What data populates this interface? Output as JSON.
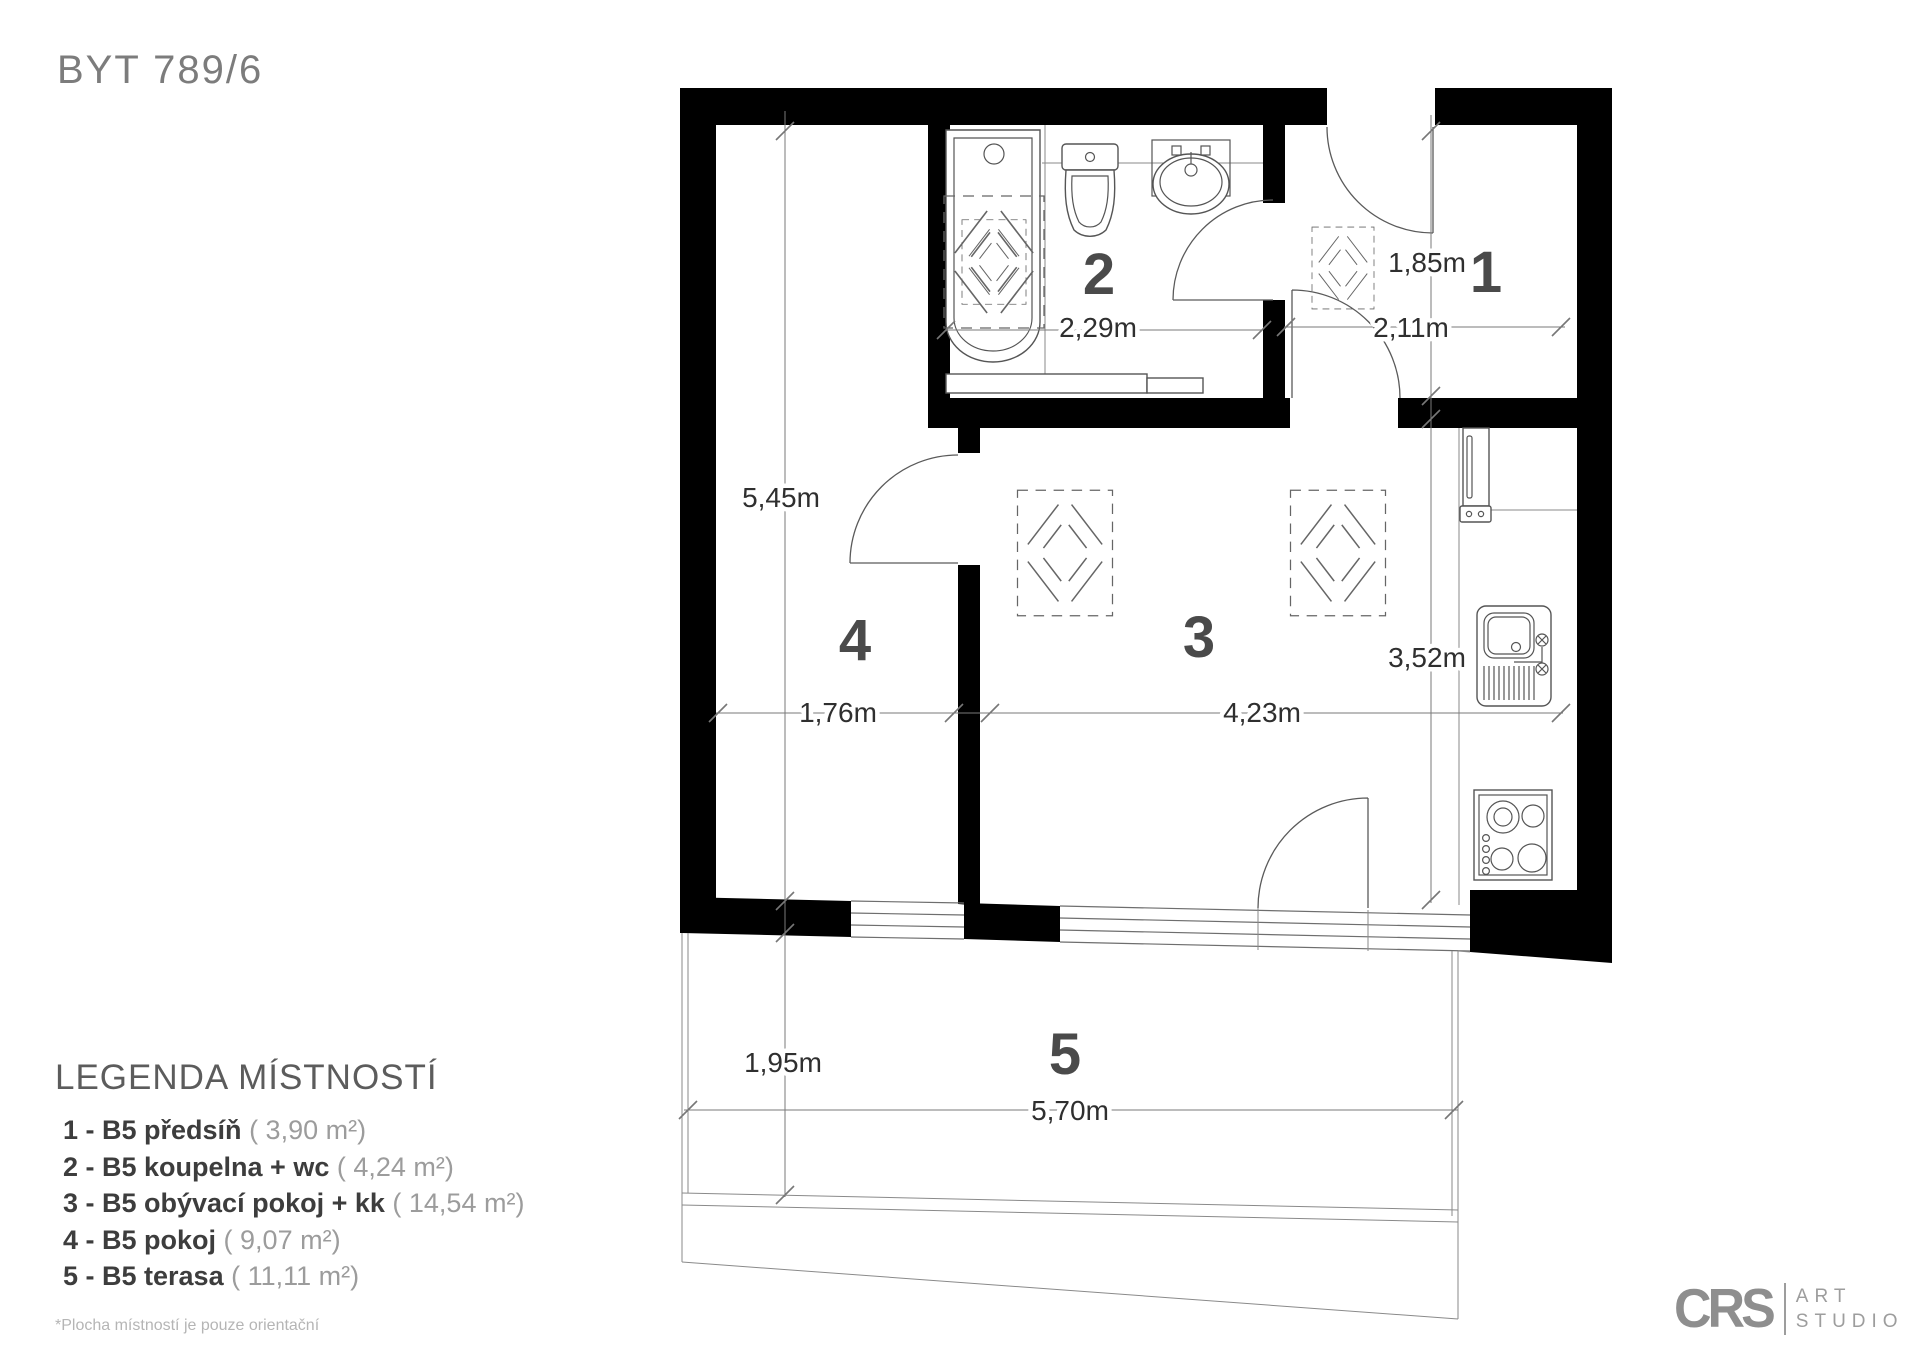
{
  "title": "BYT 789/6",
  "legend": {
    "heading": "LEGENDA MÍSTNOSTÍ",
    "items": [
      {
        "label": "1 - B5 předsíň",
        "area": "( 3,90 m²)"
      },
      {
        "label": "2 - B5 koupelna + wc",
        "area": "( 4,24 m²)"
      },
      {
        "label": "3 - B5 obývací pokoj + kk",
        "area": "( 14,54 m²)"
      },
      {
        "label": "4 - B5 pokoj",
        "area": "( 9,07 m²)"
      },
      {
        "label": "5 - B5 terasa",
        "area": "( 11,11 m²)"
      }
    ],
    "footnote": "*Plocha místností je pouze orientační"
  },
  "rooms": {
    "hall": "1",
    "bathroom": "2",
    "living": "3",
    "bedroom": "4",
    "terrace": "5"
  },
  "dimensions": {
    "bathroom_width": "2,29m",
    "hall_depth": "1,85m",
    "hall_width": "2,11m",
    "bedroom_height": "5,45m",
    "bedroom_width": "1,76m",
    "living_width": "4,23m",
    "living_height": "3,52m",
    "terrace_depth": "1,95m",
    "terrace_width": "5,70m"
  },
  "logo": {
    "initials": "CRS",
    "word1": "ART",
    "word2": "STUDIO"
  },
  "colors": {
    "wall": "#000000",
    "thin_line": "#6e6e6e",
    "dim_text": "#2f2f2f",
    "room_number": "#4a4a4a",
    "title_gray": "#7c7c7c",
    "legend_bold": "#3d3d3d",
    "legend_light": "#9c9c9c",
    "logo_gray": "#8e8e8e"
  }
}
